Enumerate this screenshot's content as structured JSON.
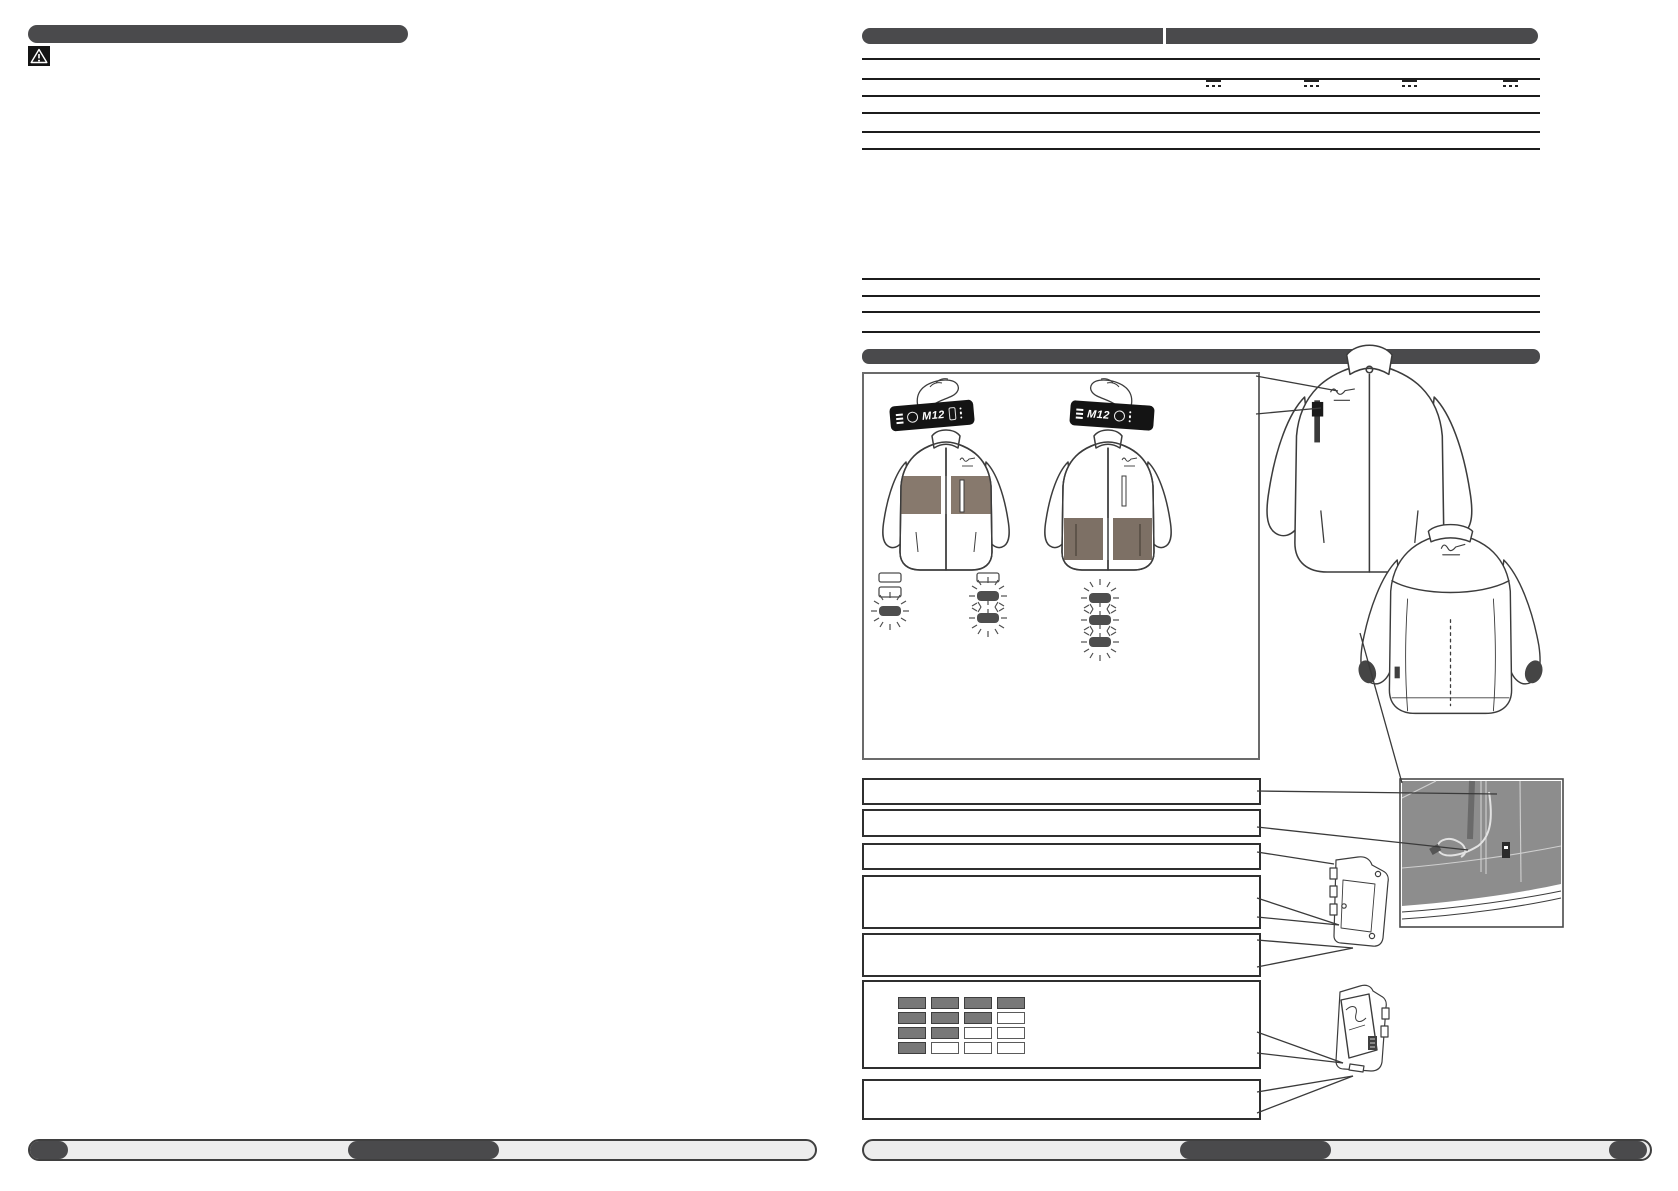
{
  "left_page": {
    "icons": {
      "warning": "warning-triangle-icon"
    }
  },
  "right_page": {
    "controller_label": "M12",
    "dc_symbol": {
      "name": "dc-voltage-symbol",
      "glyph": "⎓",
      "count": 4
    },
    "spec_table_row_count": 5,
    "secondary_table_row_count": 3,
    "callout_box_count": 7,
    "led_grid": {
      "rows": [
        [
          1,
          1,
          1,
          1
        ],
        [
          1,
          1,
          1,
          0
        ],
        [
          1,
          1,
          0,
          0
        ],
        [
          1,
          0,
          0,
          0
        ]
      ]
    },
    "figure": {
      "jacket_views": [
        "front-chest-heat-zone",
        "front-pocket-heat-zone",
        "front-large",
        "back"
      ],
      "heat_level_clusters": 3,
      "detail_views": [
        "inner-pocket-cord-panel",
        "battery-holder-empty",
        "battery-holder-with-battery"
      ]
    }
  },
  "colors": {
    "bar_dark": "#4a4a4c",
    "jacket_band": "#87796d",
    "detail_panel": "#8d8d8d",
    "led_on": "#787878",
    "footer_fill": "#ededed",
    "rule_line": "#1c1c1c"
  }
}
